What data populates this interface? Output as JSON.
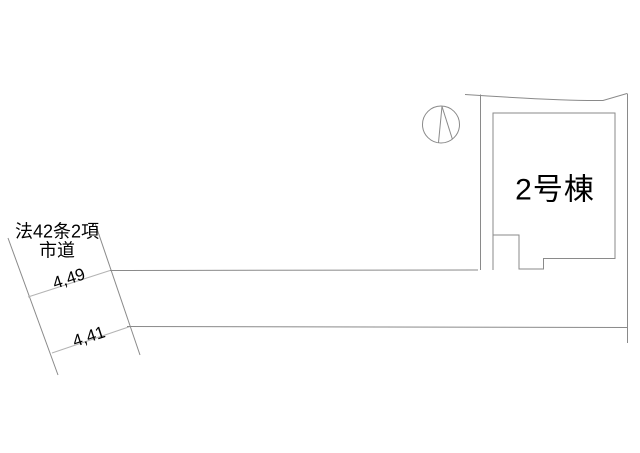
{
  "plan": {
    "road": {
      "law_label": "法42条2項",
      "type_label": "市道",
      "dim_upper": "4,49",
      "dim_lower": "4,41"
    },
    "building": {
      "label": "2号棟"
    }
  },
  "colors": {
    "line": "#8a8a8a",
    "line_light": "#b3b3b3",
    "text": "#000000",
    "background": "#ffffff"
  }
}
